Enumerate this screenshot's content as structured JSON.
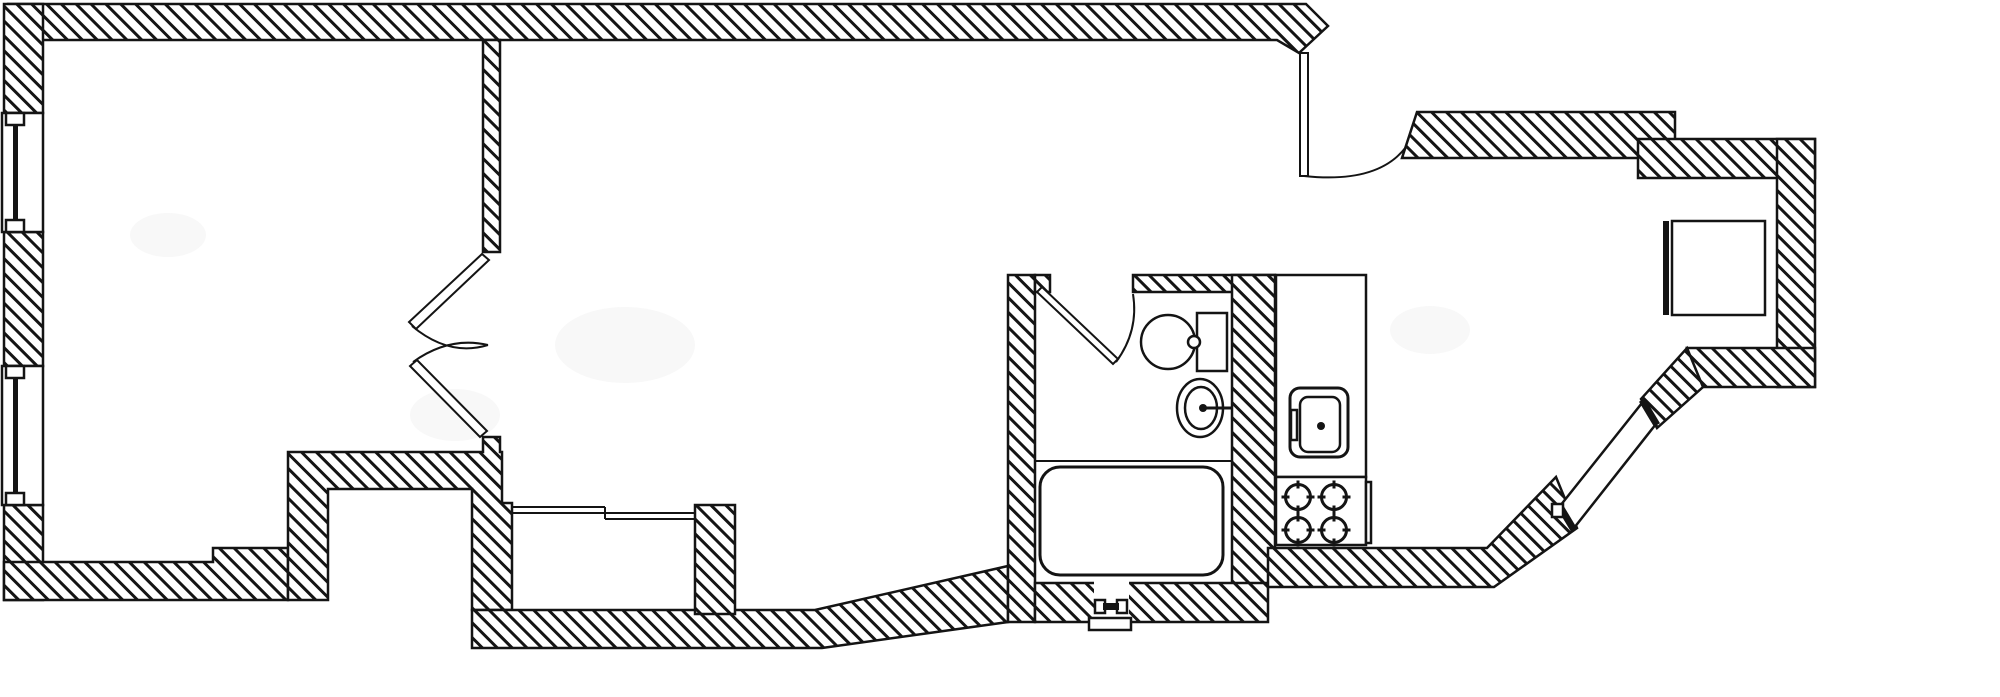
{
  "plan": {
    "kind": "apartment floor plan line drawing",
    "canvas": {
      "width": 2000,
      "height": 697
    },
    "colors": {
      "background": "#ffffff",
      "line": "#141414",
      "wall_fill": "#ffffff"
    },
    "wall_hatch": "45-degree diagonal hatching",
    "counts": {
      "windows": 3,
      "door_leaves": 5,
      "stove_burners": 4
    }
  },
  "labels": {
    "drawing": "architectural floor plan",
    "top_wall": "exterior wall top",
    "left_wall": "exterior wall left",
    "bottom_wall": "exterior wall bottom",
    "right_wall": "exterior wall right",
    "partition": "interior partition wall",
    "window_upper": "window",
    "window_lower": "window",
    "window_slanted": "slanted window",
    "double_door": "double swing door",
    "entry_door": "entry door with swing arc",
    "bathroom_door": "bathroom door with swing arc",
    "toilet": "toilet",
    "washbasin": "washbasin with faucet",
    "bathtub": "bathtub",
    "kitchen_counter": "kitchen counter",
    "kitchen_sink": "kitchen sink",
    "stove": "four burner stove",
    "appliance": "appliance box",
    "drain": "plumbing wall connection",
    "hall_lines": "low partition lines"
  }
}
